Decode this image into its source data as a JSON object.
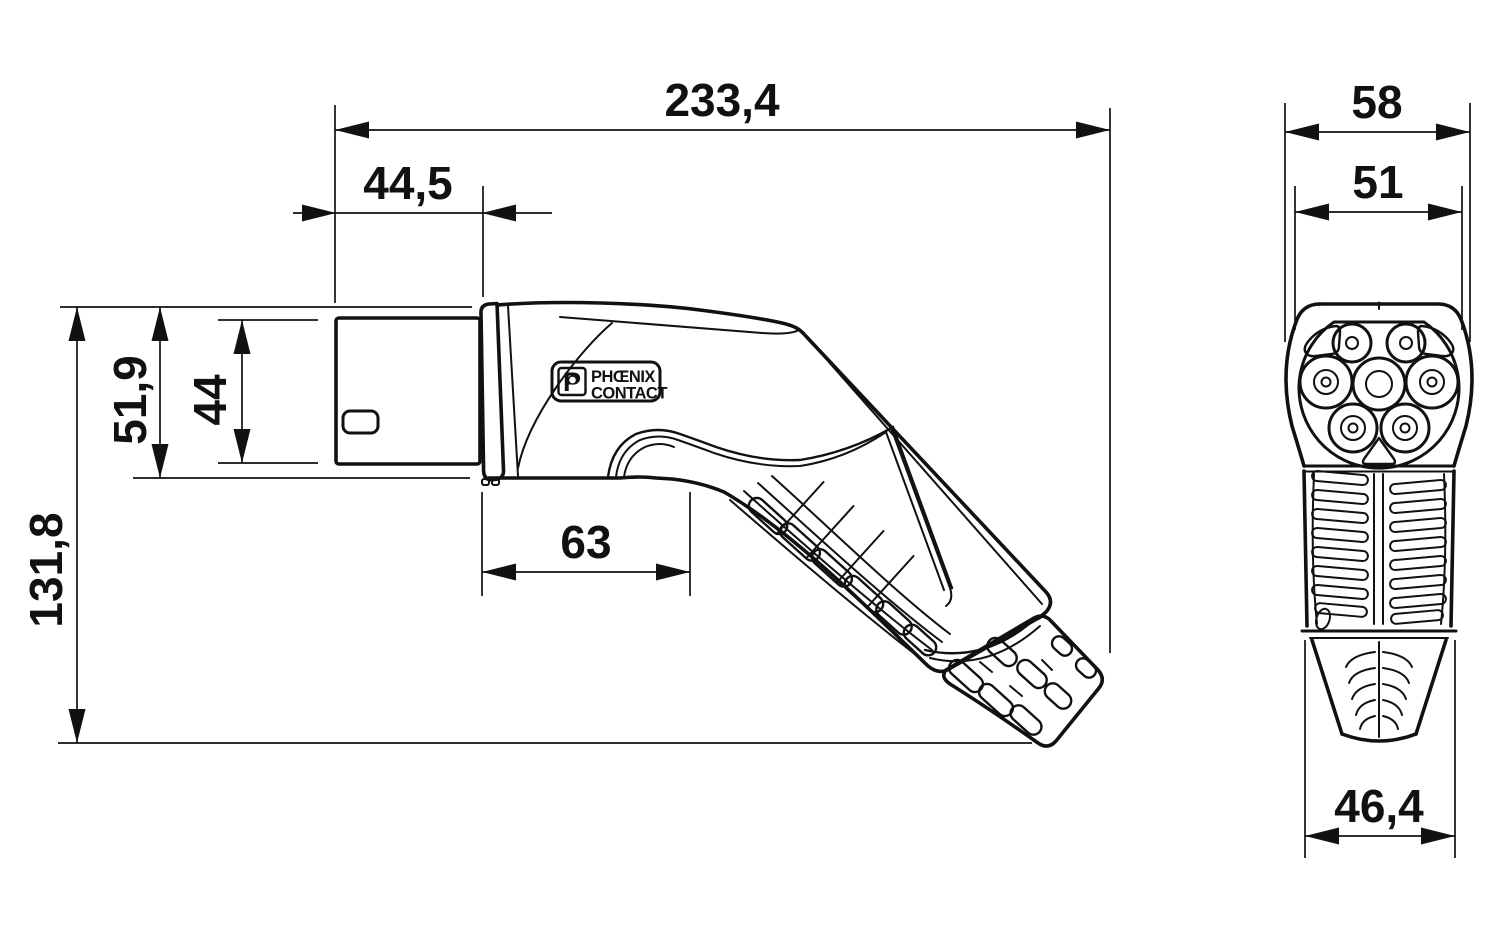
{
  "colors": {
    "line": "#111111",
    "background": "#ffffff"
  },
  "side_view": {
    "dims": {
      "overall_length": "233,4",
      "face_length": "44,5",
      "front_height": "51,9",
      "face_height": "44",
      "overall_height": "131,8",
      "grip_length": "63"
    }
  },
  "front_view": {
    "dims": {
      "overall_width": "58",
      "face_width": "51",
      "gland_width": "46,4"
    }
  },
  "logo": {
    "mark": "P",
    "brand_top": "PHŒNIX",
    "brand_bottom": "CONTACT"
  }
}
